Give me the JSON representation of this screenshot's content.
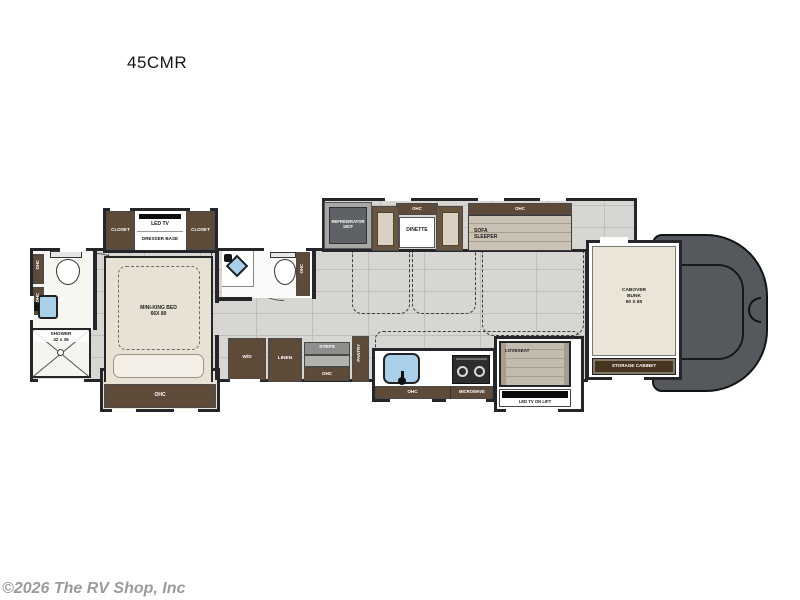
{
  "title": "45CMR",
  "copyright": "©2026 The RV Shop, Inc",
  "labels": {
    "closet": "CLOSET",
    "led_tv": "LED TV",
    "dresser_base": "DRESSER BASE",
    "ohc": "OHC",
    "shower": "SHOWER",
    "shower_size": "42 x 36",
    "bed": "MINI-KING BED",
    "bed_size": "66X 80",
    "refrigerator": "REFRIGERATOR",
    "refrigerator_size": "18CF",
    "dinette": "DINETTE",
    "sofa_line1": "SOFA",
    "sofa_line2": "SLEEPER",
    "wd": "W/D",
    "linen": "LINEN",
    "steps": "STEPS",
    "pantry": "PANTRY",
    "microwave": "MICROWAVE",
    "loveseat": "LOVESEAT",
    "tv_lift": "LED TV ON LIFT",
    "cabover_line1": "CABOVER",
    "cabover_line2": "BUNK",
    "cabover_line3": "60 X 80",
    "storage_cabinet": "STORAGE CABINET"
  },
  "colors": {
    "wall": "#26262a",
    "cabinet_brown": "#5d4a39",
    "storage_brown": "#46341f",
    "floor": "#d8d6d2",
    "grout": "#c1bfbb",
    "furniture_beige": "#e8e2d5",
    "sofa_taupe": "#c3bbae",
    "sink_blue": "#a9cfe9",
    "appliance_gray": "#5e6165",
    "cab_gray": "#55595d",
    "copyright_gray": "#9b9b9b"
  }
}
